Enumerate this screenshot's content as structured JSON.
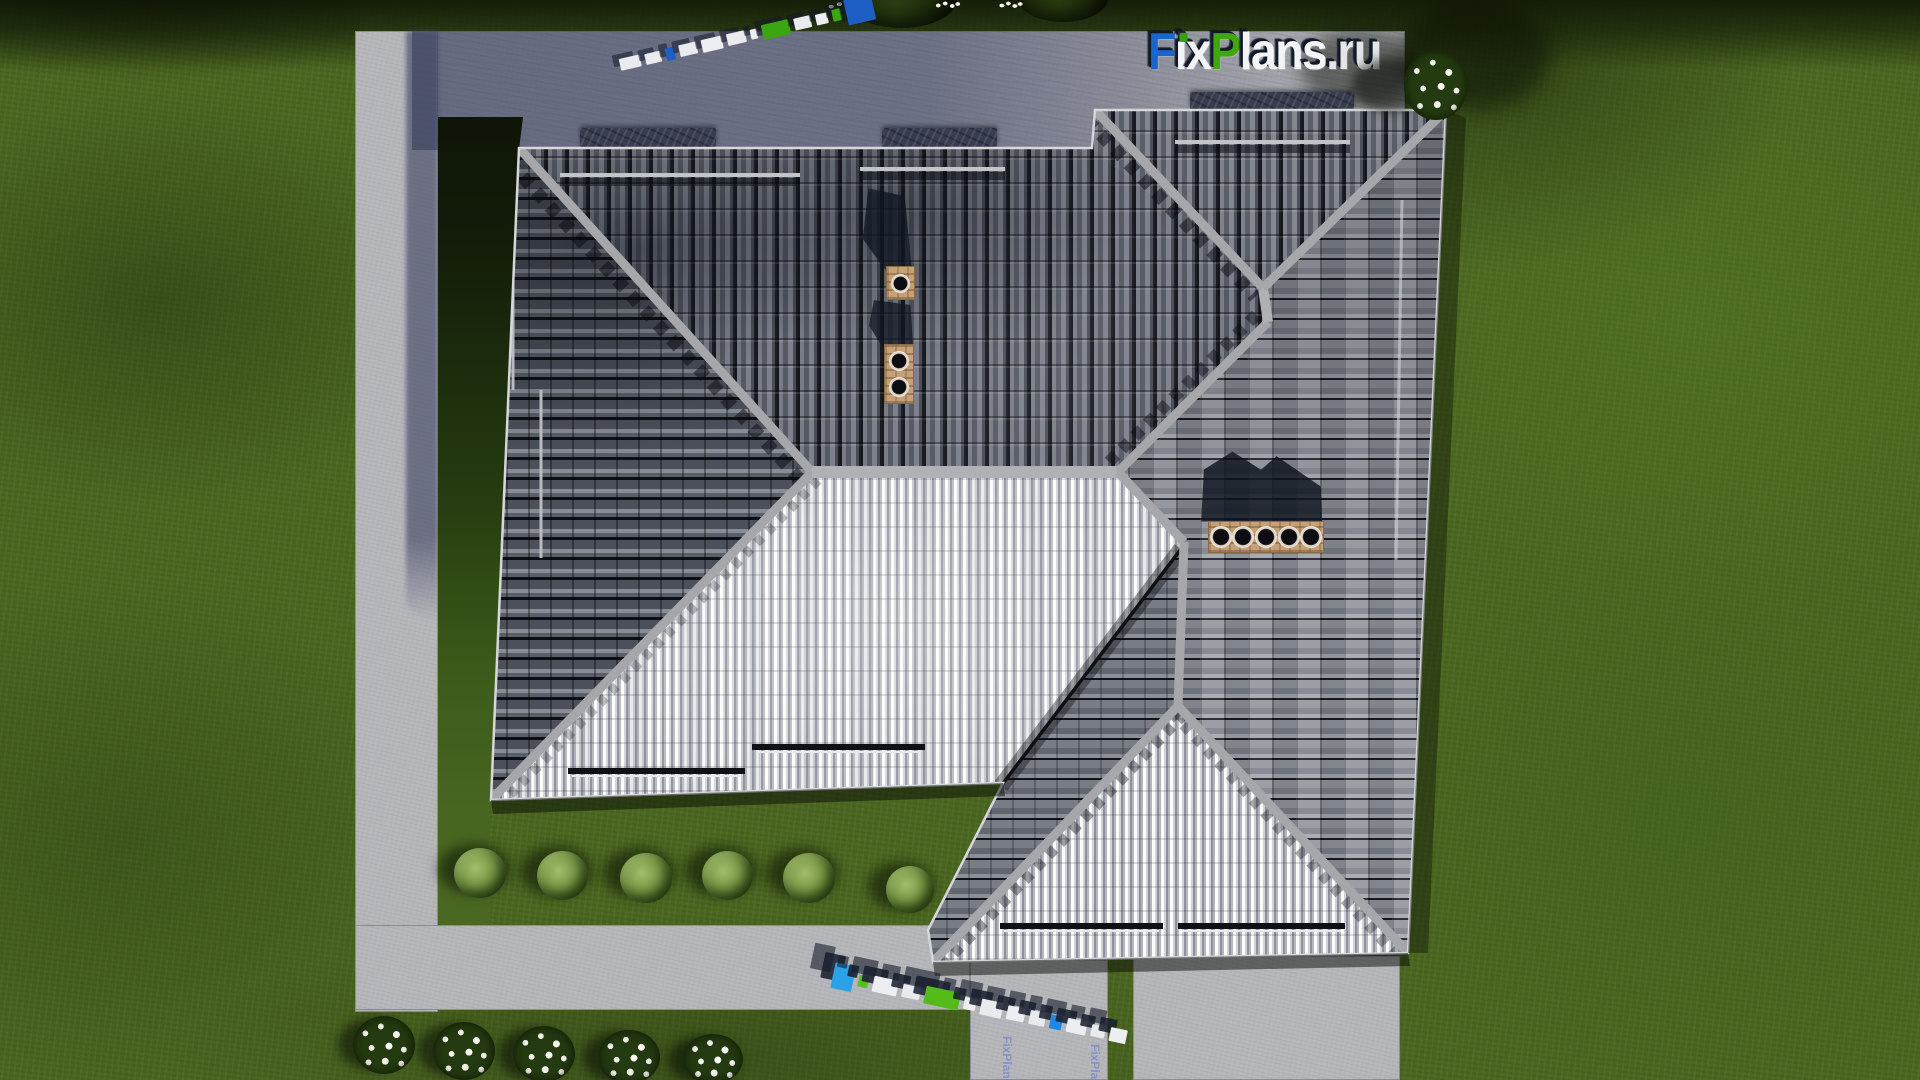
{
  "page_title": "Top view 3D render of hip-roof house plan",
  "logo": {
    "text": "FixPlans.ru",
    "letters": [
      {
        "char": "F",
        "color": "#1a66cf"
      },
      {
        "char": "i",
        "color": "#f3f4f6",
        "dot_color": "#37a20c"
      },
      {
        "char": "x",
        "color": "#f3f4f6"
      },
      {
        "char": "P",
        "color": "#3ea70e"
      },
      {
        "char": "l",
        "color": "#f3f4f6"
      },
      {
        "char": "a",
        "color": "#f3f4f6"
      },
      {
        "char": "n",
        "color": "#f3f4f6"
      },
      {
        "char": "s",
        "color": "#f3f4f6"
      },
      {
        "char": ".",
        "color": "#e4e5e8"
      },
      {
        "char": "r",
        "color": "#e4e5e8"
      },
      {
        "char": "u",
        "color": "#e4e5e8"
      }
    ]
  },
  "ground_texts": [
    {
      "text": "FixPlans.ru"
    },
    {
      "text": "FixPlans.ru"
    }
  ],
  "watermark_3d": {
    "top_row_blocks": [
      {
        "w": 30,
        "h": 12,
        "c": "#e9ebee"
      },
      {
        "w": 22,
        "h": 11,
        "c": "#e9ebee"
      },
      {
        "w": 13,
        "h": 13,
        "c": "#1d5fc4"
      },
      {
        "w": 26,
        "h": 12,
        "c": "#e9ebee"
      },
      {
        "w": 30,
        "h": 13,
        "c": "#eceef1"
      },
      {
        "w": 26,
        "h": 12,
        "c": "#e9ebee"
      },
      {
        "w": 10,
        "h": 10,
        "c": "#eceef1"
      },
      {
        "w": 40,
        "h": 15,
        "c": "#3ba512"
      },
      {
        "w": 24,
        "h": 12,
        "c": "#e9ebee"
      },
      {
        "w": 18,
        "h": 11,
        "c": "#eceef1"
      },
      {
        "w": 12,
        "h": 12,
        "c": "#3ba512"
      },
      {
        "w": 40,
        "h": 26,
        "c": "#1d5fc4"
      }
    ],
    "bottom_row_blocks": [
      {
        "w": 30,
        "h": 26,
        "c": "#2ba1e8"
      },
      {
        "w": 14,
        "h": 12,
        "c": "#58c01e"
      },
      {
        "w": 34,
        "h": 16,
        "c": "#edeef1"
      },
      {
        "w": 26,
        "h": 14,
        "c": "#e8eaed"
      },
      {
        "w": 48,
        "h": 18,
        "c": "#53bb1a"
      },
      {
        "w": 18,
        "h": 12,
        "c": "#edeef1"
      },
      {
        "w": 30,
        "h": 16,
        "c": "#e8eaed"
      },
      {
        "w": 26,
        "h": 14,
        "c": "#edeef1"
      },
      {
        "w": 22,
        "h": 14,
        "c": "#e8eaed"
      },
      {
        "w": 16,
        "h": 14,
        "c": "#1e88e5"
      },
      {
        "w": 28,
        "h": 14,
        "c": "#edeef1"
      },
      {
        "w": 20,
        "h": 12,
        "c": "#e8eaed"
      },
      {
        "w": 24,
        "h": 14,
        "c": "#edeef1"
      }
    ]
  },
  "scene": {
    "description_visible_objects": {
      "house_roof_faces": [
        "north-slope",
        "west-slope",
        "east-slope",
        "south-bright-slope",
        "wing-north-slope",
        "wing-west-slope",
        "wing-south-triangle"
      ],
      "chimneys": [
        {
          "flues": 1
        },
        {
          "flues": 2
        },
        {
          "flues": 5
        }
      ],
      "snow_rails_count": 5,
      "bushes_count": 6,
      "flower_clusters_bottom": 5,
      "flower_cluster_top_right": 1,
      "trees_top_count": 2
    },
    "colors": {
      "grass": "#4a661f",
      "paving_lit": "#b5b6ba",
      "paving_shadow": "#5f6588",
      "roof_dark_tile": "#4b4f58",
      "roof_bright_tile": "#eef0f2",
      "ridge": "#a6a7ab",
      "chimney_brick": "#c5a078",
      "logo_blue": "#1a66cf",
      "logo_green": "#3ea70e",
      "watermark_blue": "#2ba1e8",
      "watermark_green": "#53bb1a"
    }
  }
}
